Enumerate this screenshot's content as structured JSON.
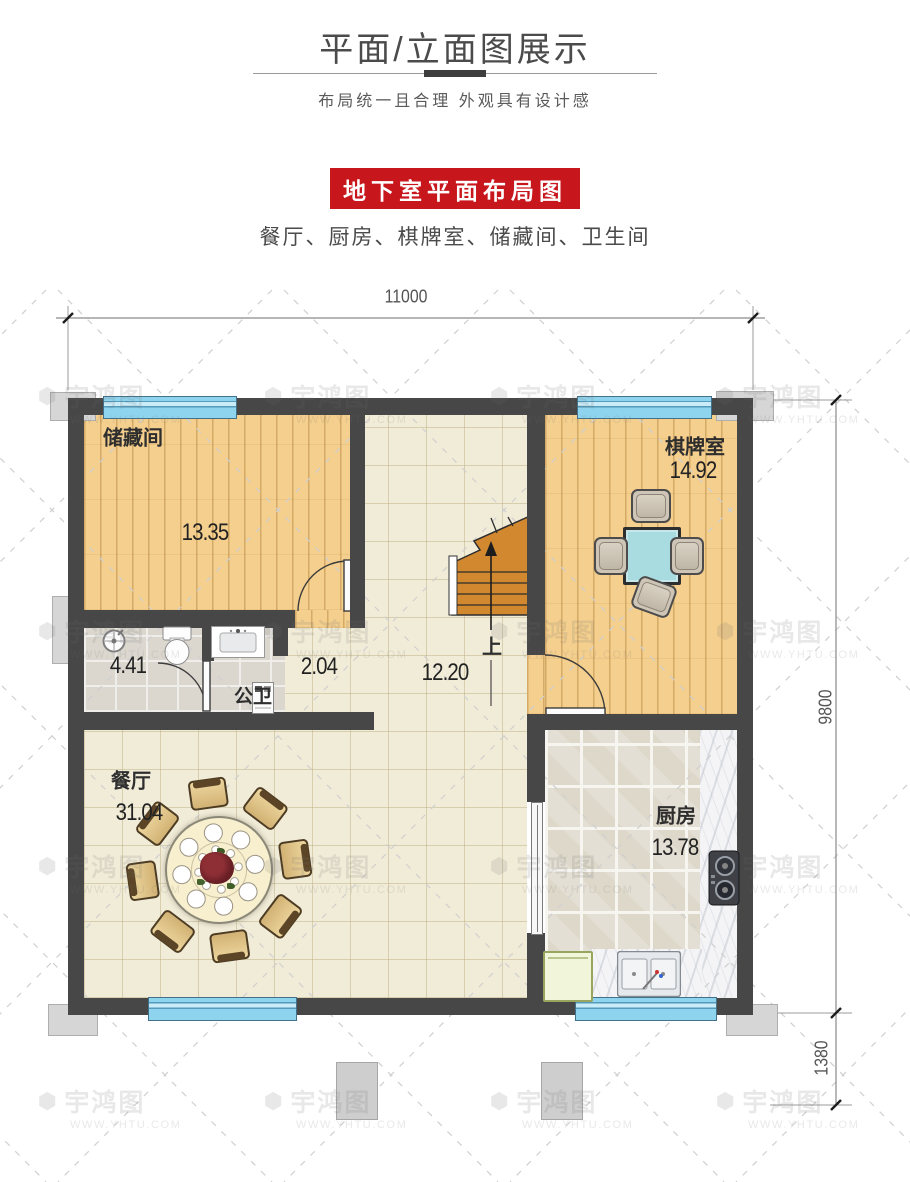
{
  "header": {
    "title": "平面/立面图展示",
    "subtitle": "布局统一且合理 外观具有设计感",
    "banner": "地下室平面布局图",
    "room_list": "餐厅、厨房、棋牌室、储藏间、卫生间"
  },
  "dimensions": {
    "top_width": "11000",
    "right_height": "9800",
    "porch_depth": "1380"
  },
  "rooms": {
    "storage": {
      "name": "储藏间",
      "area": "13.35"
    },
    "chess": {
      "name": "棋牌室",
      "area": "14.92"
    },
    "bath": {
      "name": "公卫",
      "shower_area": "4.41",
      "passage_area": "2.04"
    },
    "hall": {
      "area": "12.20",
      "up": "上"
    },
    "dining": {
      "name": "餐厅",
      "area": "31.04"
    },
    "kitchen": {
      "name": "厨房",
      "area": "13.78"
    }
  },
  "watermark": {
    "brand": "宇鸿图",
    "url": "WWW.YHTU.COM",
    "logo_glyph": "⬢"
  },
  "colors": {
    "accent_red": "#c8161d",
    "wall": "#474747",
    "window": "#8fd4ee",
    "wood_floor": "#f4cf8e",
    "tile_floor": "#f1ecd8",
    "stairs": "#d2882e",
    "mahjong_table": "#a8dce0"
  }
}
